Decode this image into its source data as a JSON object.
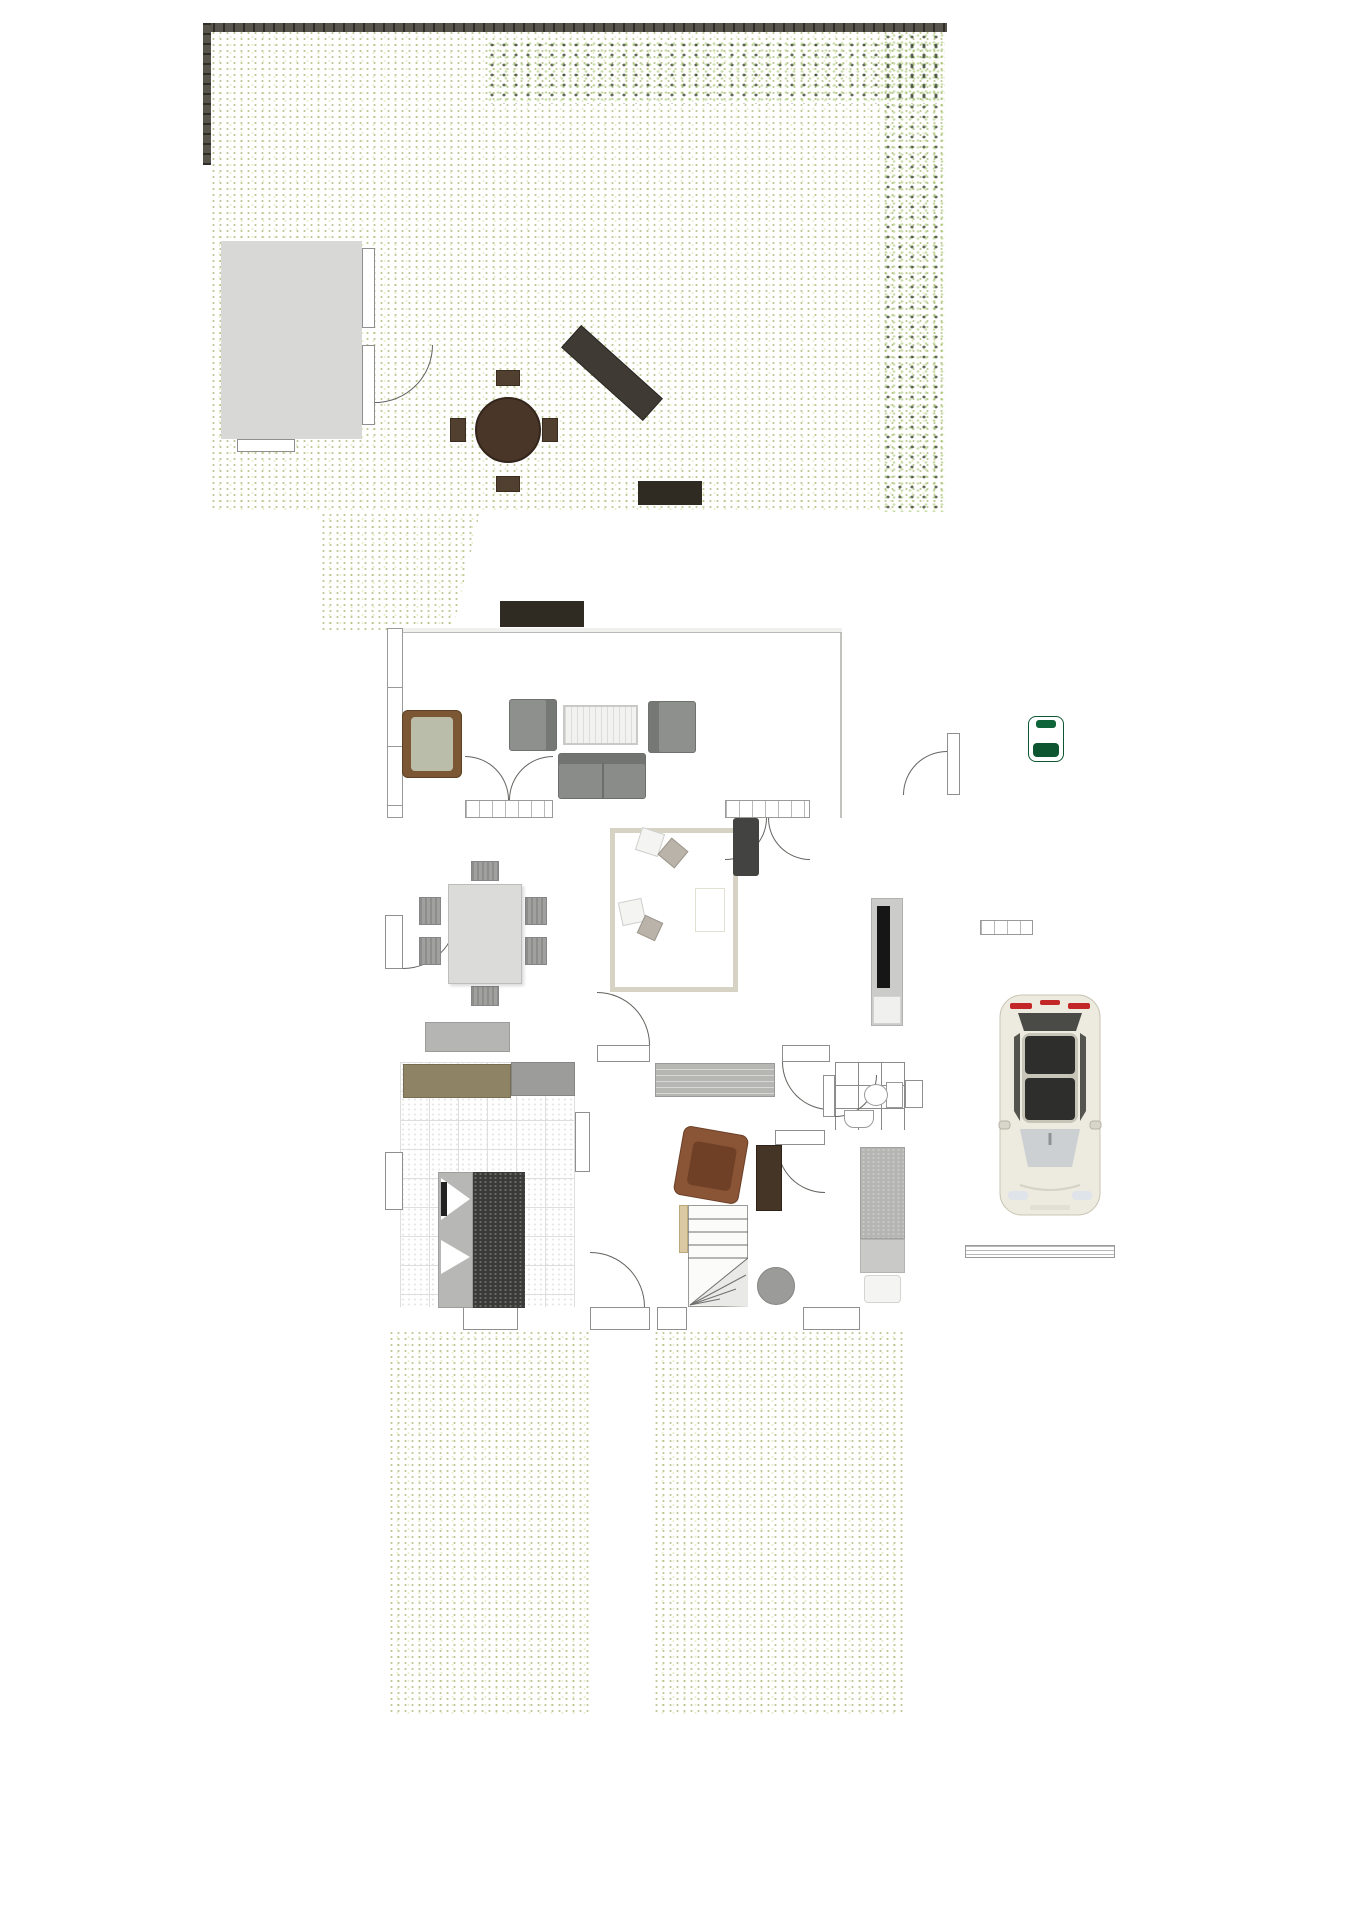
{
  "caption": "Exposéplan, nicht maßstäblich",
  "plan": {
    "type": "residential-site-floor-plan-top-view",
    "areas": [
      "garden",
      "patio",
      "garden-shed",
      "terrace",
      "living-dining-room",
      "kitchen",
      "hallway",
      "bathroom",
      "bedroom",
      "storage-room",
      "garage",
      "driveway",
      "front-garden",
      "street"
    ],
    "objects": [
      "hedge",
      "fence",
      "apple-tree",
      "flower-bushes",
      "planter-boxes",
      "garden-dining-set",
      "garden-bench",
      "lounge-set",
      "rattan-lounger",
      "potted-plants",
      "dining-table-six-chairs",
      "corner-sofa",
      "rug",
      "tv-lowboard",
      "sideboard",
      "kitchen-island-with-sink",
      "winder-staircase",
      "armchair",
      "toilet",
      "washbasin",
      "single-bed",
      "wardrobe",
      "pouf",
      "lawn-mower",
      "shelves",
      "white-car"
    ]
  },
  "colors": {
    "lawn": "#a7b259",
    "hedge": "#3c5723",
    "pavers": "#c6c7c3",
    "paverJoint": "#aeafab",
    "street": "#aeaeae",
    "wall": "#9a9169",
    "floor": "#e4e4e2",
    "terraceFloor": "#dcddd9",
    "kitchenFloor": "#f5f5f3",
    "bathFloor": "#9e9e9c",
    "garageFloor": "#f0eadf",
    "wood": "#3e2f23",
    "sofaDark": "#4b4c49",
    "rug": "#c3beae",
    "carBody": "#edeadf",
    "mowerGreen": "#157a44",
    "flowerRed": "#a81c1c",
    "flowerWhite": "#f2f2f2",
    "flowerYellow": "#e6d44e",
    "fruitOrange": "#cf5f28"
  }
}
